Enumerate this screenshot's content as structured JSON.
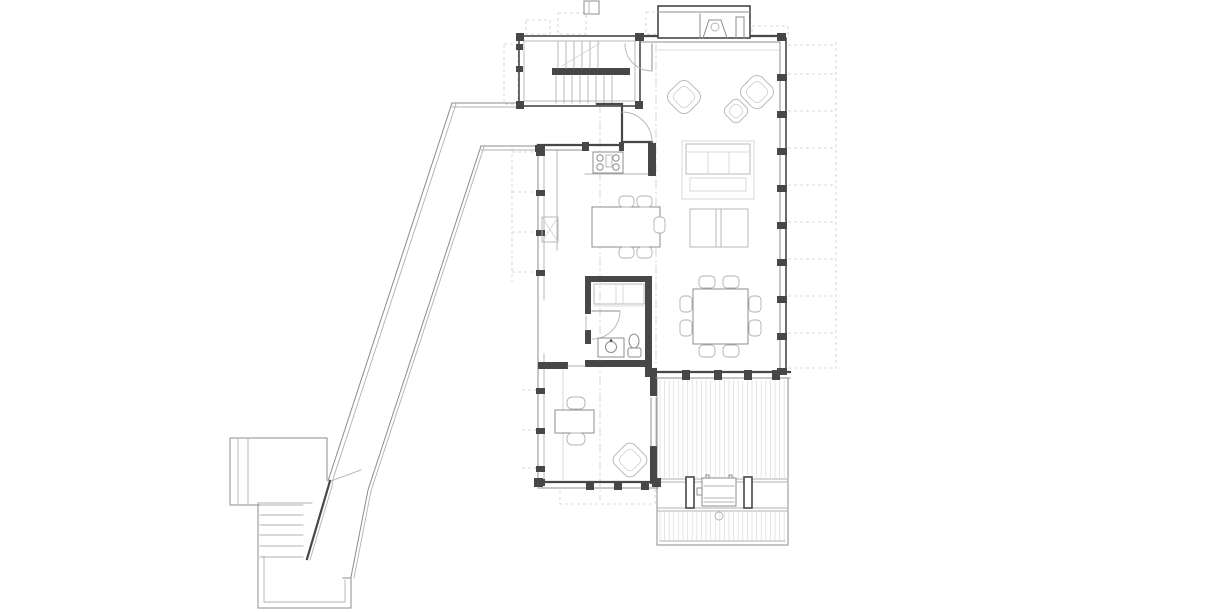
{
  "drawing": {
    "kind": "architectural-floor-plan",
    "rooms": [
      {
        "name": "stair-hall"
      },
      {
        "name": "entry-vestibule"
      },
      {
        "name": "kitchen"
      },
      {
        "name": "living-area"
      },
      {
        "name": "dining-area"
      },
      {
        "name": "bathroom"
      },
      {
        "name": "closet"
      },
      {
        "name": "bedroom"
      },
      {
        "name": "deck"
      },
      {
        "name": "ramp-walkway"
      },
      {
        "name": "exterior-stairs"
      },
      {
        "name": "upper-landing"
      },
      {
        "name": "lower-landing"
      },
      {
        "name": "fireplace"
      }
    ],
    "furniture": [
      "lounge-armchair",
      "lounge-armchair",
      "ottoman",
      "sofa",
      "coffee-table-pair",
      "dining-table",
      "dining-chair-x8",
      "kitchen-island",
      "island-stool-x5",
      "stove",
      "kitchen-sink",
      "toilet",
      "vanity-sink",
      "desk",
      "desk-chair-x2",
      "bedroom-armchair",
      "barbecue-grill"
    ]
  },
  "colors": {
    "wall": "#474747",
    "mid": "#8c8c8c",
    "light": "#b2b2b2",
    "xlight": "#d0d0d0",
    "dash": "#cccccc",
    "hatch": "#dcdcdc"
  },
  "geometry": {
    "deck_hatch": {
      "x1": 660,
      "x2": 786,
      "step": 4.6,
      "bands": [
        [
          380,
          478
        ],
        [
          512,
          541
        ]
      ]
    },
    "right_wall": {
      "posts_y": [
        74,
        111,
        148,
        185,
        222,
        259,
        296,
        333
      ],
      "overhang_dash_y": [
        45,
        74,
        111,
        148,
        185,
        222,
        259,
        296,
        333,
        368
      ]
    },
    "left_wall": {
      "posts_y": [
        150,
        190,
        230,
        270,
        388,
        428,
        466
      ],
      "dash_y_upper": [
        152,
        192,
        232,
        272
      ],
      "dash_y_lower": [
        390,
        430,
        468
      ]
    },
    "stair_hall": {
      "upper_treads_x": [
        558,
        566,
        574,
        582,
        590,
        598
      ],
      "lower_treads_x": [
        556,
        564,
        572,
        580,
        588,
        596,
        604,
        612
      ]
    },
    "exterior_stairs": {
      "treads_y": [
        505,
        515,
        525,
        535,
        546,
        557
      ],
      "x1": 260,
      "x2": 303
    },
    "south_wall_posts_x": [
      682,
      714,
      744,
      772
    ],
    "bedroom_wall_ticks_x": [
      586,
      614,
      641
    ],
    "dining_chairs": [
      [
        699,
        276,
        16,
        12
      ],
      [
        723,
        276,
        16,
        12
      ],
      [
        699,
        345,
        16,
        12
      ],
      [
        723,
        345,
        16,
        12
      ],
      [
        680,
        296,
        12,
        16
      ],
      [
        680,
        320,
        12,
        16
      ],
      [
        749,
        296,
        12,
        16
      ],
      [
        749,
        320,
        12,
        16
      ]
    ],
    "island_stools": [
      [
        619,
        196,
        15,
        11
      ],
      [
        637,
        196,
        15,
        11
      ],
      [
        619,
        247,
        15,
        11
      ],
      [
        637,
        247,
        15,
        11
      ],
      [
        654,
        217,
        11,
        16
      ]
    ]
  }
}
